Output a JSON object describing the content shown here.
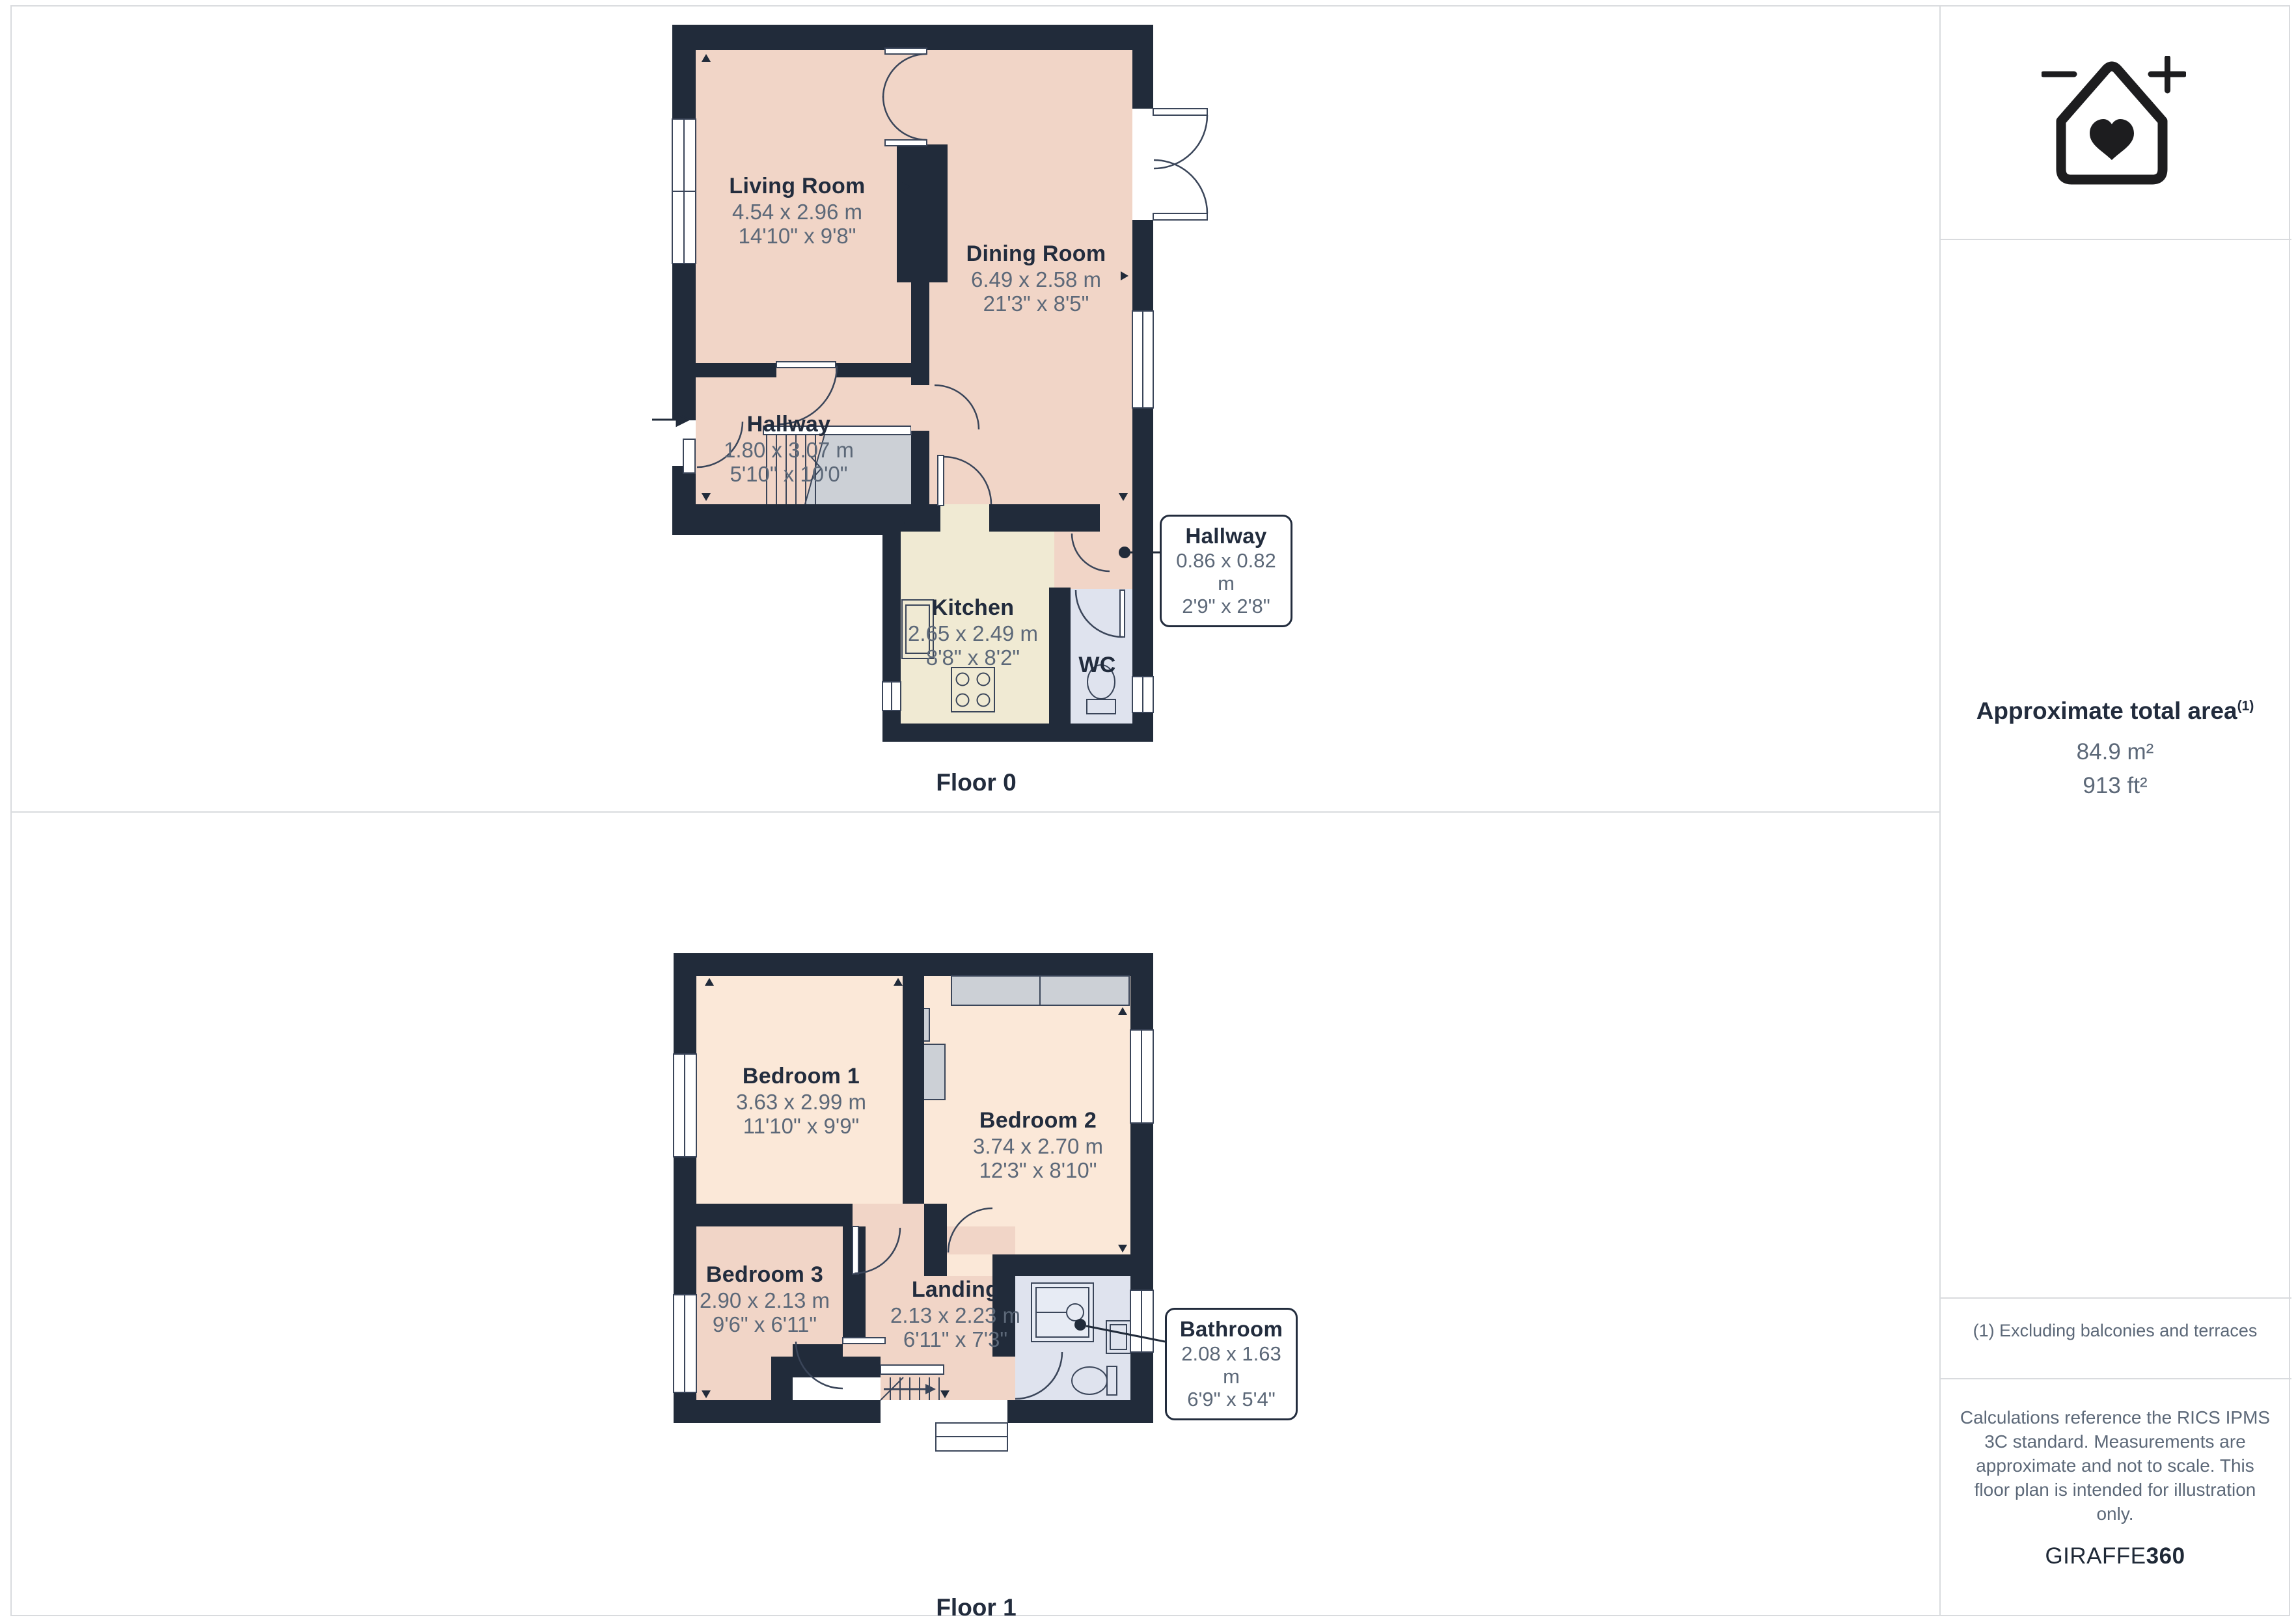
{
  "floors": [
    {
      "label": "Floor 0",
      "rooms": [
        {
          "name": "Living Room",
          "metric": "4.54 x 2.96 m",
          "imperial": "14'10\" x 9'8\""
        },
        {
          "name": "Dining Room",
          "metric": "6.49 x 2.58 m",
          "imperial": "21'3\" x 8'5\""
        },
        {
          "name": "Hallway",
          "metric": "1.80 x 3.07 m",
          "imperial": "5'10\" x 10'0\""
        },
        {
          "name": "Kitchen",
          "metric": "2.65 x 2.49 m",
          "imperial": "8'8\" x 8'2\""
        },
        {
          "name": "WC"
        }
      ],
      "callout": {
        "name": "Hallway",
        "metric": "0.86 x 0.82 m",
        "imperial": "2'9\" x 2'8\""
      }
    },
    {
      "label": "Floor 1",
      "rooms": [
        {
          "name": "Bedroom 1",
          "metric": "3.63 x 2.99 m",
          "imperial": "11'10\" x 9'9\""
        },
        {
          "name": "Bedroom 2",
          "metric": "3.74 x 2.70 m",
          "imperial": "12'3\" x 8'10\""
        },
        {
          "name": "Bedroom 3",
          "metric": "2.90 x 2.13 m",
          "imperial": "9'6\" x 6'11\""
        },
        {
          "name": "Landing",
          "metric": "2.13 x 2.23 m",
          "imperial": "6'11\" x 7'3\""
        }
      ],
      "callout": {
        "name": "Bathroom",
        "metric": "2.08 x 1.63 m",
        "imperial": "6'9\" x 5'4\""
      }
    }
  ],
  "sidebar": {
    "area_title": "Approximate total area",
    "area_footnote_marker": "(1)",
    "area_m2": "84.9 m²",
    "area_ft2": "913 ft²",
    "footnote": "(1) Excluding balconies and terraces",
    "disclaimer": "Calculations reference the RICS IPMS 3C standard. Measurements are approximate and not to scale. This floor plan is intended for illustration only.",
    "brand_regular": "GIRAFFE",
    "brand_bold": "360"
  },
  "icons": {
    "logo": "house-with-heart-zoom-icon",
    "entry": "entry-arrow-icon"
  },
  "colors": {
    "wall": "#212b3a",
    "room_warm": "#f1d5c7",
    "room_warm_light": "#fbe8d8",
    "kitchen": "#f0ead3",
    "wet_room": "#dfe3ee",
    "storage_gray": "#ccd0d6",
    "title_text": "#222c3d",
    "dim_text": "#5c6878",
    "divider": "#d9dbde"
  }
}
